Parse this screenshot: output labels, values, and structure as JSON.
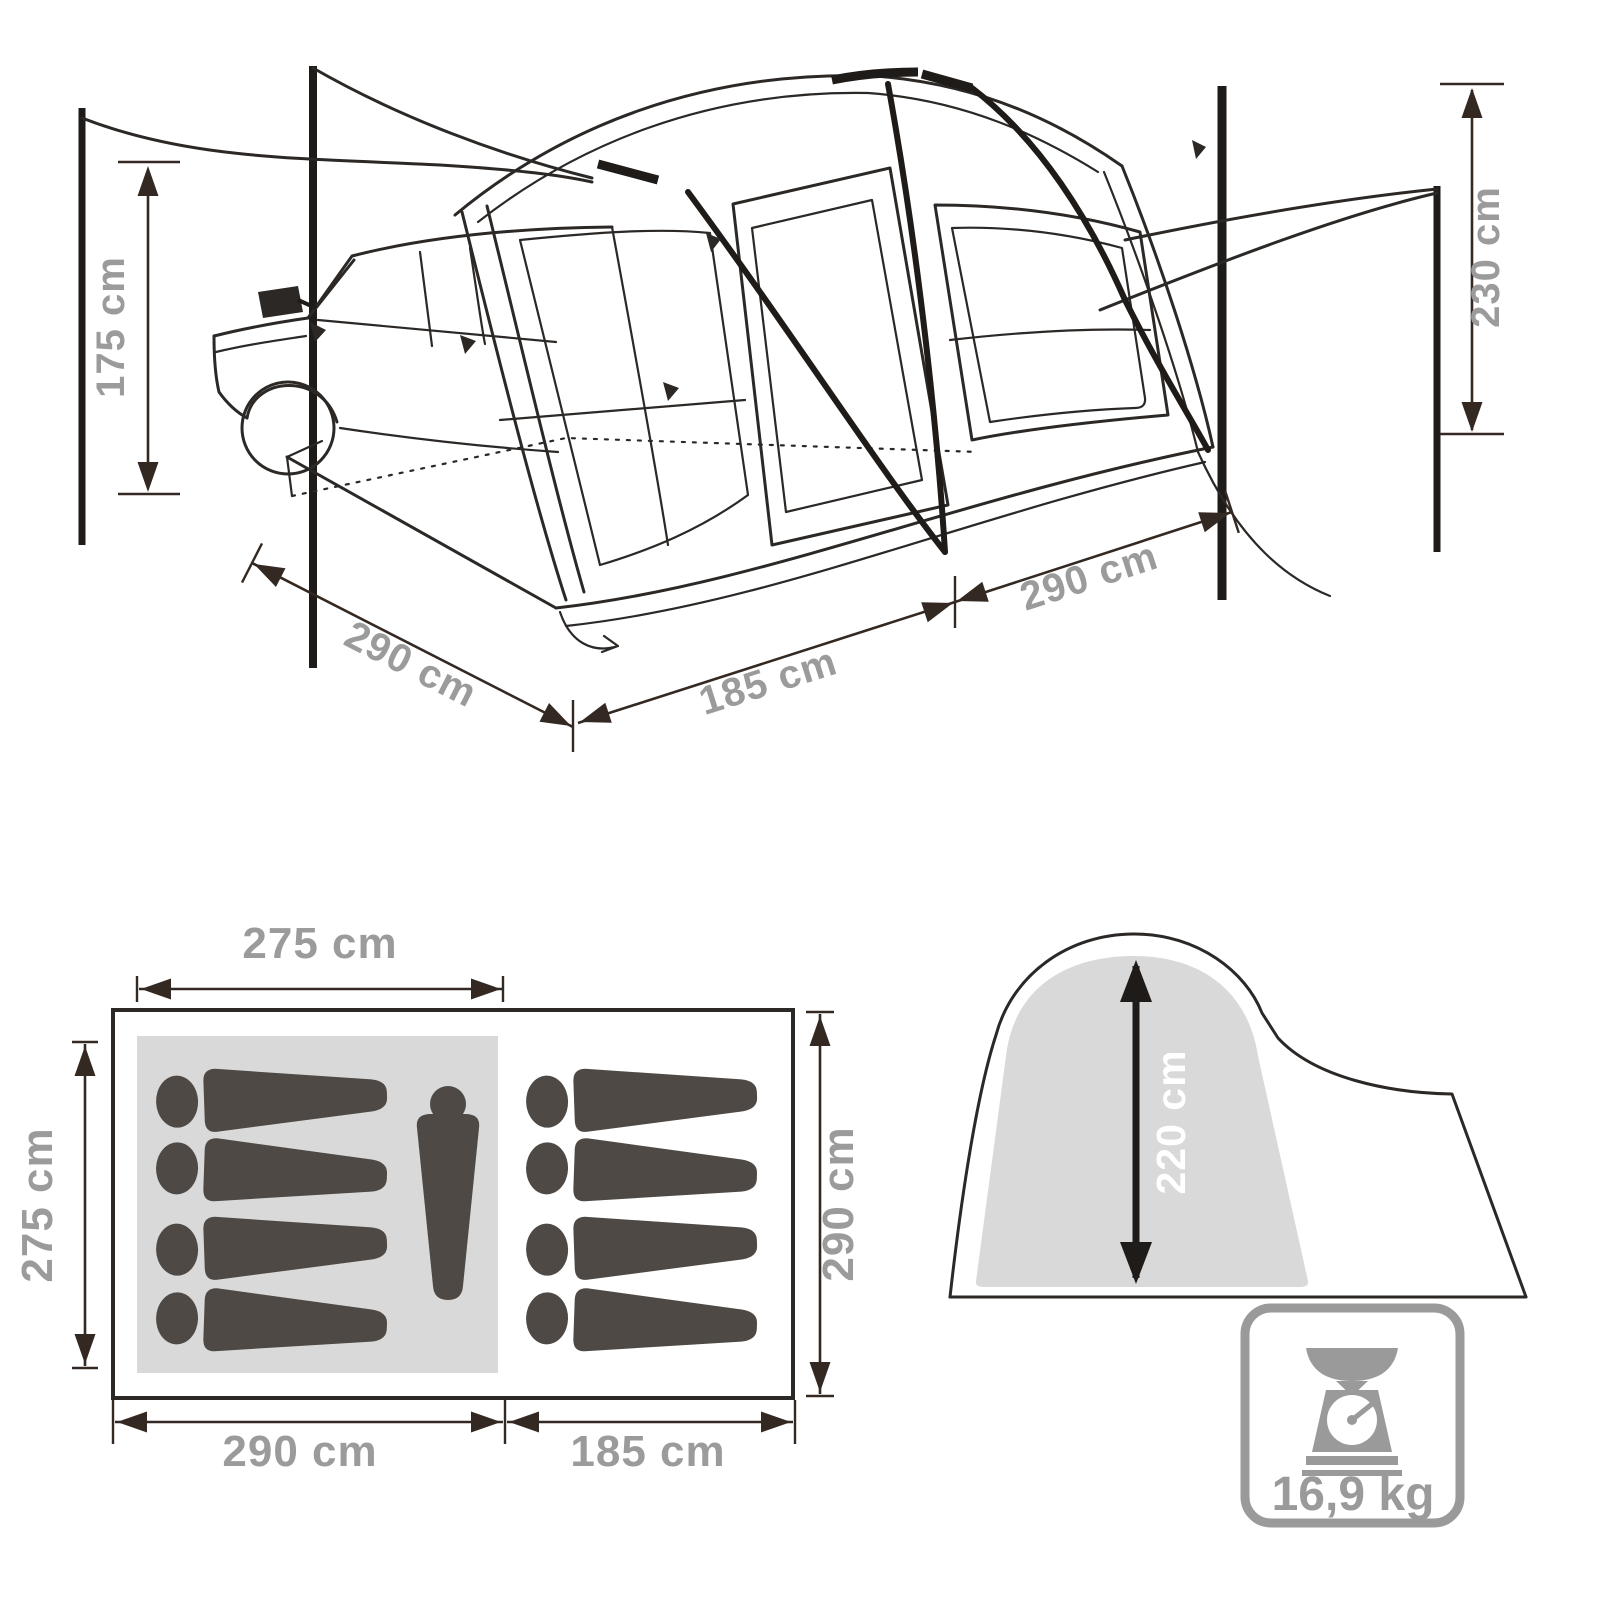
{
  "title": "tent-dimensions-diagram",
  "perspective_view": {
    "pole_height_left": "175 cm",
    "pole_height_right": "230 cm",
    "depth_left": "290 cm",
    "front_width": "185 cm",
    "depth_right": "290 cm"
  },
  "floor_plan": {
    "top_width": "275 cm",
    "left_depth": "275 cm",
    "right_depth": "290 cm",
    "bottom_main_width": "290 cm",
    "bottom_porch_width": "185 cm",
    "sleeping_pads_left": 4,
    "sleeping_pads_right": 4,
    "standing_persons": 1
  },
  "side_profile": {
    "inner_height": "220 cm"
  },
  "weight_badge": {
    "value": "16,9 kg",
    "icon": "kitchen-scale-icon"
  },
  "colors": {
    "background": "#ffffff",
    "line_art": "#2b2826",
    "dimension_arrows": "#332922",
    "dimension_text": "#9b9b9b",
    "gray_fill": "#d9d9d9",
    "item_dark": "#4e4944",
    "side_label_text": "#ffffff",
    "weight_gray": "#9a9a9a"
  }
}
